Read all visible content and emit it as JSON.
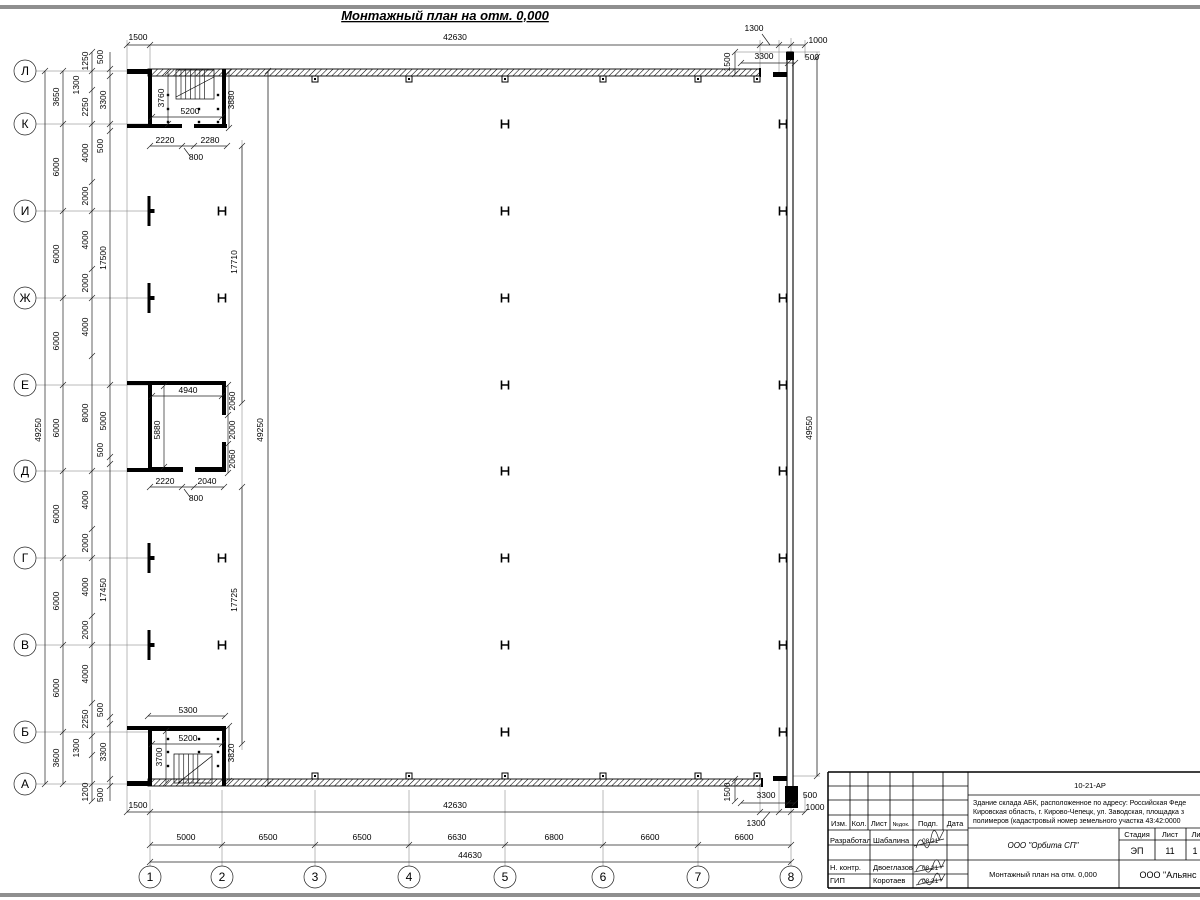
{
  "page": {
    "title": "Монтажный план на отм. 0,000"
  },
  "axes": {
    "left": [
      "Л",
      "К",
      "И",
      "Ж",
      "Е",
      "Д",
      "Г",
      "В",
      "Б",
      "А"
    ],
    "bottom": [
      "1",
      "2",
      "3",
      "4",
      "5",
      "6",
      "7",
      "8"
    ]
  },
  "dims": {
    "top": {
      "offset": "1500",
      "total": "42630",
      "right_1300": "1300",
      "right_1000": "1000",
      "right_1500": "1500",
      "right_3300": "3300",
      "right_500": "500"
    },
    "bottom": {
      "offset": "1500",
      "total": "42630",
      "right_1500": "1500",
      "right_3300": "3300",
      "right_500": "500",
      "right_1000": "1000",
      "right_1300": "1300",
      "segments": [
        "5000",
        "6500",
        "6500",
        "6630",
        "6800",
        "6600",
        "6600"
      ],
      "overall": "44630"
    },
    "left": {
      "overall": "49250",
      "spacing": [
        "3650",
        "6000",
        "6000",
        "6000",
        "6000",
        "6000",
        "6000",
        "6000",
        "3600"
      ],
      "sub": [
        "1250",
        "1300",
        "2250",
        "4000",
        "2000",
        "4000",
        "2000",
        "4000",
        "8000",
        "4000",
        "2000",
        "4000",
        "2000",
        "4000",
        "2250",
        "1300",
        "1200"
      ],
      "wall": [
        "500",
        "3300",
        "500",
        "17500",
        "5000",
        "500",
        "17450",
        "500",
        "3300",
        "500"
      ]
    },
    "interior": {
      "span_top": "17710",
      "span_bottom": "17725",
      "overall": "49250",
      "right_overall": "49550"
    },
    "room_top": {
      "width": "5200",
      "left": "3760",
      "right": "3880",
      "b1": "2220",
      "b2": "2280",
      "door": "800"
    },
    "room_mid": {
      "width": "4940",
      "height": "5880",
      "r1": "2060",
      "r2": "2000",
      "r3": "2060",
      "b1": "2220",
      "b2": "2040",
      "door": "800"
    },
    "room_bot": {
      "top": "5300",
      "width": "5200",
      "left": "3700",
      "right": "3820"
    }
  },
  "titleblock": {
    "doc_number": "10-21-АР",
    "description": [
      "Здание склада АБК, расположенное по адресу: Российская Феде",
      "Кировская область, г. Кирово-Чепецк, ул. Заводская, площадка з",
      "полимеров (кадастровый номер земельного участка 43:42:0000"
    ],
    "header": [
      "Изм.",
      "Кол.",
      "Лист",
      "№док.",
      "Подп.",
      "Дата"
    ],
    "rows": [
      {
        "role": "Разработал",
        "name": "Шабалина",
        "date": "08.21"
      },
      {
        "role": "Н. контр.",
        "name": "Двоеглазов",
        "date": "08.21"
      },
      {
        "role": "ГИП",
        "name": "Коротаев",
        "date": "08.21"
      }
    ],
    "org": "ООО \"Орбита СП\"",
    "stage_label": "Стадия",
    "sheet_label": "Лист",
    "sheets_label": "Ли",
    "stage": "ЭП",
    "sheet": "11",
    "sheets": "1",
    "drawing_title": "Монтажный план на отм. 0,000",
    "company": "ООО \"Альянс"
  }
}
